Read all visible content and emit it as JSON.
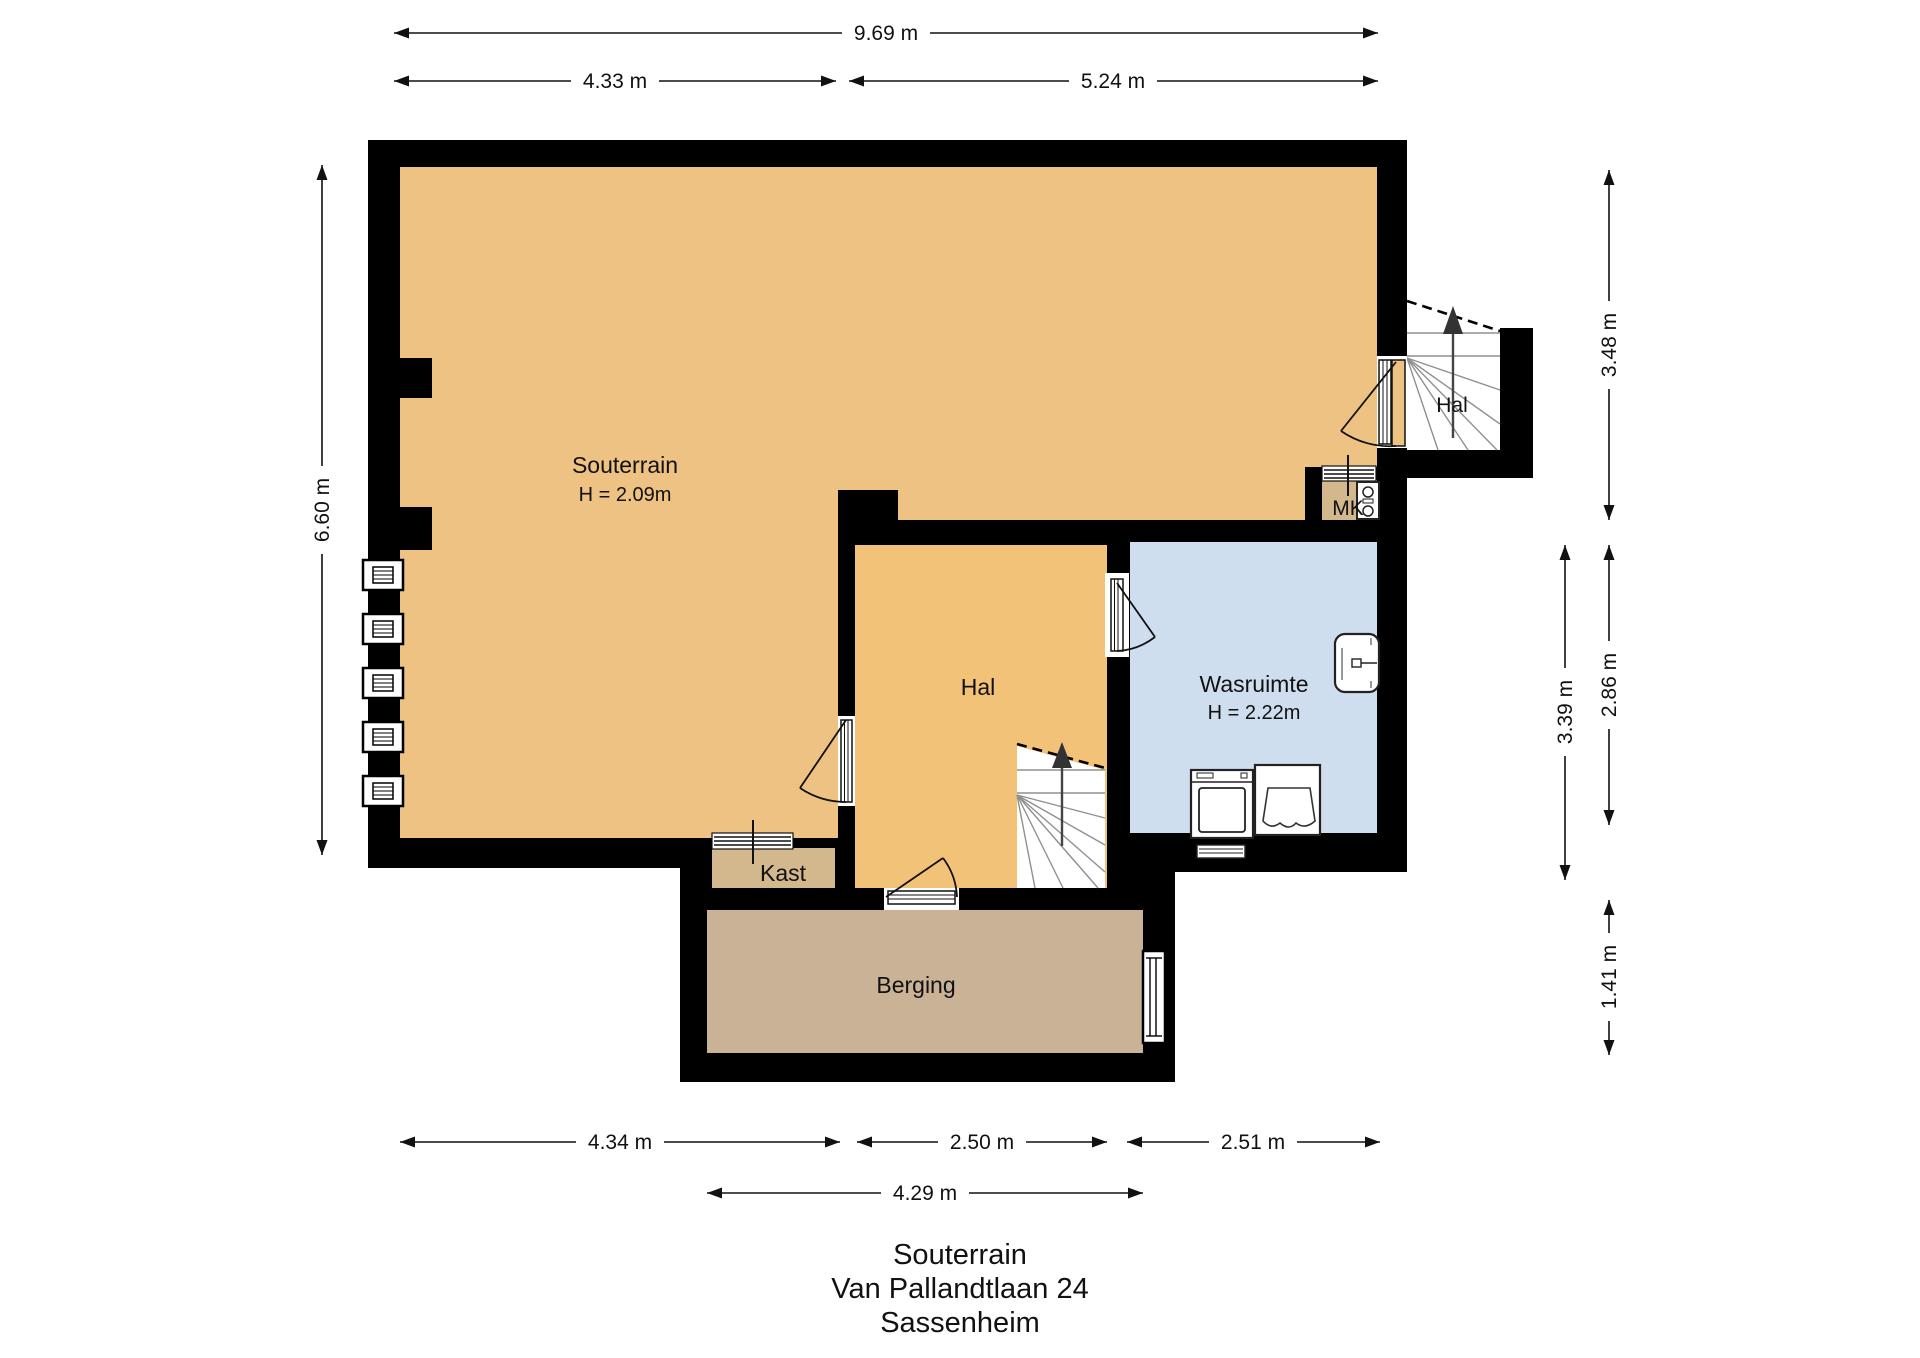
{
  "plan": {
    "rooms": {
      "souterrain": {
        "label": "Souterrain",
        "height": "H = 2.09m"
      },
      "hal_boven": {
        "label": "Hal"
      },
      "mk": {
        "label": "MK"
      },
      "hal": {
        "label": "Hal"
      },
      "wasruimte": {
        "label": "Wasruimte",
        "height": "H = 2.22m"
      },
      "kast": {
        "label": "Kast"
      },
      "berging": {
        "label": "Berging"
      }
    },
    "dimensions": {
      "top_total": "9.69 m",
      "top_left": "4.33 m",
      "top_right": "5.24 m",
      "left_height": "6.60 m",
      "right_upper": "3.48 m",
      "right_outer": "3.39 m",
      "right_inner": "2.86 m",
      "right_lower": "1.41 m",
      "bottom_left": "4.34 m",
      "bottom_center": "2.50 m",
      "bottom_right": "2.51 m",
      "bottom_berging": "4.29 m"
    },
    "title": {
      "floor": "Souterrain",
      "address": "Van Pallandtlaan 24",
      "city": "Sassenheim"
    },
    "colors": {
      "wall": "#000000",
      "floor_souterrain": "#edc283",
      "floor_hal": "#f3c279",
      "floor_wasruimte": "#cfdeee",
      "floor_kast": "#d3b78d",
      "floor_berging": "#c9b296",
      "stair_floor": "#ffffff"
    }
  }
}
